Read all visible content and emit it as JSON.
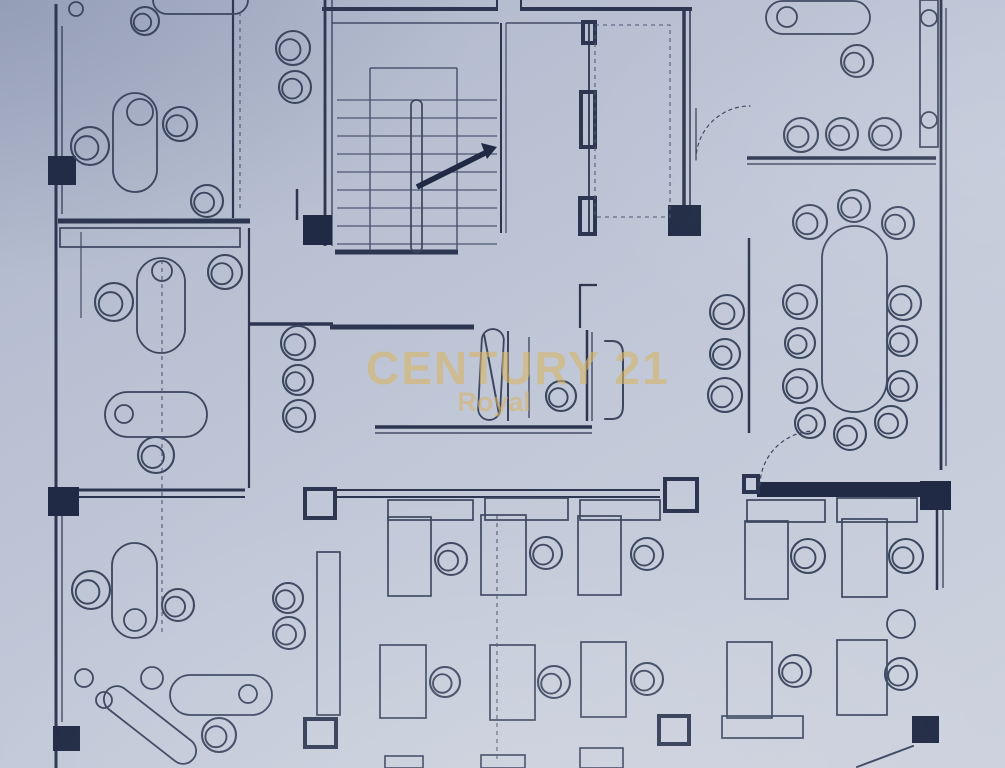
{
  "watermark": {
    "line1": "CENTURY 21",
    "line2": "Royal"
  },
  "colors": {
    "paper_top": "#a7b1c8",
    "paper_mid": "#c0c7d7",
    "paper_bottom": "#cdd2de",
    "ink_wall": "#2c3650",
    "ink_line": "#3b465f",
    "ink_thin": "#4d5772",
    "column_fill": "#202a44",
    "watermark_gold": "rgba(214,181,104,0.62)"
  },
  "floorplan": {
    "canvas": {
      "width": 1005,
      "height": 768
    },
    "walls": [
      [
        56,
        4,
        56,
        768,
        3
      ],
      [
        62,
        26,
        62,
        214,
        1.2
      ],
      [
        62,
        496,
        62,
        722,
        1.2
      ],
      [
        58,
        221,
        250,
        221,
        5
      ],
      [
        81,
        232,
        81,
        318,
        1
      ],
      [
        233,
        0,
        233,
        218,
        2.2
      ],
      [
        297,
        189,
        297,
        220,
        2.5
      ],
      [
        325,
        0,
        325,
        246,
        2.8
      ],
      [
        332,
        0,
        332,
        246,
        1.2
      ],
      [
        322,
        9,
        497,
        9,
        4
      ],
      [
        520,
        9,
        692,
        9,
        4
      ],
      [
        497,
        0,
        497,
        11,
        2
      ],
      [
        521,
        0,
        521,
        11,
        2
      ],
      [
        332,
        23,
        499,
        23,
        1.2
      ],
      [
        506,
        23,
        585,
        23,
        1.2
      ],
      [
        501,
        23,
        501,
        233,
        2
      ],
      [
        506,
        23,
        506,
        233,
        1
      ],
      [
        589,
        22,
        589,
        235,
        1.8
      ],
      [
        684,
        9,
        684,
        235,
        3.5
      ],
      [
        690,
        9,
        690,
        235,
        1.5
      ],
      [
        696,
        108,
        696,
        160,
        1.2
      ],
      [
        335,
        252,
        458,
        252,
        5
      ],
      [
        330,
        327,
        474,
        327,
        5
      ],
      [
        508,
        331,
        508,
        421,
        1.8
      ],
      [
        529,
        337,
        529,
        418,
        1.2
      ],
      [
        587,
        330,
        587,
        421,
        2.5
      ],
      [
        592,
        332,
        592,
        421,
        1.2
      ],
      [
        375,
        427,
        592,
        427,
        3.5
      ],
      [
        375,
        433,
        592,
        433,
        1.2
      ],
      [
        580,
        284,
        580,
        328,
        2.2
      ],
      [
        580,
        285,
        597,
        285,
        2.2
      ],
      [
        749,
        238,
        749,
        433,
        2.5
      ],
      [
        747,
        158,
        936,
        158,
        3.5
      ],
      [
        747,
        164,
        936,
        164,
        1.2
      ],
      [
        941,
        0,
        941,
        470,
        2.8
      ],
      [
        946,
        8,
        946,
        466,
        1.2
      ],
      [
        249,
        228,
        249,
        488,
        2.2
      ],
      [
        249,
        324,
        333,
        324,
        3.5
      ],
      [
        335,
        490,
        660,
        490,
        2
      ],
      [
        335,
        497,
        660,
        497,
        2
      ],
      [
        58,
        490,
        245,
        490,
        3
      ],
      [
        58,
        497,
        245,
        497,
        2
      ],
      [
        937,
        490,
        937,
        590,
        2.5
      ],
      [
        943,
        492,
        943,
        588,
        1.2
      ]
    ],
    "columns_filled": [
      [
        48,
        156,
        28,
        29
      ],
      [
        48,
        487,
        31,
        29
      ],
      [
        53,
        726,
        27,
        25
      ],
      [
        303,
        215,
        29,
        30
      ],
      [
        668,
        205,
        33,
        31
      ],
      [
        757,
        482,
        165,
        15
      ],
      [
        920,
        481,
        31,
        29
      ],
      [
        912,
        716,
        27,
        27
      ]
    ],
    "columns_outlined": [
      [
        305,
        489,
        30,
        29
      ],
      [
        665,
        479,
        32,
        32
      ],
      [
        305,
        719,
        31,
        28
      ],
      [
        659,
        716,
        30,
        28
      ],
      [
        581,
        92,
        14,
        55
      ],
      [
        580,
        198,
        15,
        36
      ],
      [
        583,
        22,
        12,
        21
      ],
      [
        744,
        476,
        14,
        16
      ]
    ],
    "rects": [
      [
        60,
        228,
        180,
        19
      ],
      [
        388,
        500,
        85,
        20
      ],
      [
        485,
        498,
        83,
        22
      ],
      [
        580,
        500,
        80,
        20
      ],
      [
        388,
        517,
        43,
        79
      ],
      [
        481,
        515,
        45,
        80
      ],
      [
        578,
        516,
        43,
        79
      ],
      [
        380,
        645,
        46,
        73
      ],
      [
        490,
        645,
        45,
        75
      ],
      [
        581,
        642,
        45,
        75
      ],
      [
        385,
        756,
        38,
        12
      ],
      [
        481,
        755,
        44,
        13
      ],
      [
        580,
        748,
        43,
        20
      ],
      [
        747,
        500,
        78,
        22
      ],
      [
        837,
        498,
        80,
        24
      ],
      [
        745,
        521,
        43,
        78
      ],
      [
        842,
        519,
        45,
        78
      ],
      [
        727,
        642,
        45,
        76
      ],
      [
        837,
        640,
        50,
        75
      ],
      [
        722,
        716,
        81,
        22
      ],
      [
        920,
        0,
        18,
        147
      ],
      [
        317,
        552,
        23,
        163
      ]
    ],
    "pills": [
      [
        113,
        93,
        44,
        99,
        0
      ],
      [
        153,
        -14,
        95,
        28,
        0
      ],
      [
        137,
        258,
        48,
        95,
        0
      ],
      [
        105,
        392,
        102,
        45,
        0
      ],
      [
        112,
        543,
        45,
        95,
        0
      ],
      [
        170,
        675,
        102,
        40,
        0
      ],
      [
        95,
        712,
        110,
        26,
        38
      ],
      [
        766,
        1,
        104,
        33,
        0
      ],
      [
        822,
        226,
        65,
        186,
        0
      ],
      [
        480,
        329,
        22,
        91,
        3
      ]
    ],
    "dots": [
      [
        140,
        112,
        13
      ],
      [
        162,
        271,
        10
      ],
      [
        124,
        414,
        9
      ],
      [
        135,
        620,
        11
      ],
      [
        248,
        694,
        9
      ],
      [
        787,
        17,
        10
      ],
      [
        929,
        18,
        8
      ],
      [
        929,
        120,
        8
      ],
      [
        76,
        9,
        7
      ],
      [
        84,
        678,
        9
      ],
      [
        104,
        700,
        8
      ],
      [
        152,
        678,
        11
      ],
      [
        901,
        624,
        14
      ]
    ],
    "chairs": [
      [
        90,
        146,
        19
      ],
      [
        180,
        124,
        17
      ],
      [
        207,
        201,
        16
      ],
      [
        145,
        21,
        14
      ],
      [
        293,
        48,
        17
      ],
      [
        295,
        87,
        16
      ],
      [
        114,
        302,
        19
      ],
      [
        225,
        272,
        17
      ],
      [
        156,
        455,
        18
      ],
      [
        298,
        343,
        17
      ],
      [
        298,
        380,
        15
      ],
      [
        299,
        416,
        16
      ],
      [
        91,
        590,
        19
      ],
      [
        178,
        605,
        16
      ],
      [
        219,
        735,
        17
      ],
      [
        288,
        598,
        15
      ],
      [
        289,
        633,
        16
      ],
      [
        561,
        396,
        15
      ],
      [
        451,
        559,
        16
      ],
      [
        546,
        553,
        16
      ],
      [
        647,
        554,
        16
      ],
      [
        445,
        682,
        15
      ],
      [
        554,
        682,
        16
      ],
      [
        647,
        679,
        16
      ],
      [
        808,
        556,
        17
      ],
      [
        906,
        556,
        17
      ],
      [
        795,
        671,
        16
      ],
      [
        901,
        674,
        16
      ],
      [
        857,
        61,
        16
      ],
      [
        801,
        135,
        17
      ],
      [
        842,
        134,
        16
      ],
      [
        885,
        134,
        16
      ],
      [
        854,
        206,
        16
      ],
      [
        810,
        222,
        17
      ],
      [
        898,
        223,
        16
      ],
      [
        800,
        302,
        17
      ],
      [
        800,
        343,
        15
      ],
      [
        800,
        386,
        17
      ],
      [
        810,
        423,
        15
      ],
      [
        850,
        434,
        16
      ],
      [
        904,
        303,
        17
      ],
      [
        902,
        341,
        15
      ],
      [
        902,
        386,
        15
      ],
      [
        891,
        422,
        16
      ],
      [
        727,
        312,
        17
      ],
      [
        725,
        354,
        15
      ],
      [
        725,
        395,
        17
      ]
    ],
    "dashes": [
      [
        240,
        12,
        240,
        212
      ],
      [
        162,
        260,
        162,
        635
      ],
      [
        497,
        515,
        497,
        760
      ]
    ],
    "dash_rects": [
      [
        595,
        25,
        75,
        192
      ]
    ],
    "paths": [
      {
        "d": "M 696,160 A 54,54 0 0 1 750,106",
        "w": 1.2,
        "dash": true
      },
      {
        "d": "M 760,485 A 55,55 0 0 1 814,431",
        "w": 1.2,
        "dash": true
      },
      {
        "d": "M 605,341 L 612,341 Q 623,341 623,354 L 623,406 Q 623,419 612,419 L 605,419",
        "w": 2,
        "dash": false
      },
      {
        "d": "M 857,767 L 913,746",
        "w": 2,
        "dash": false
      },
      {
        "d": "M 484,334 L 499,414",
        "w": 2,
        "dash": false
      }
    ],
    "stairs": {
      "tread_x1": 337,
      "tread_x2": 497,
      "tread_ys": [
        100,
        118,
        136,
        154,
        172,
        190,
        208,
        226,
        244
      ],
      "stringer_xs": [
        370,
        457
      ],
      "stringer_y1": 68,
      "stringer_y2": 250,
      "rail": [
        411,
        100,
        11,
        152
      ],
      "arrow": [
        417,
        187,
        491,
        150
      ],
      "arrow_head": "497,147 481,143 487,159"
    }
  }
}
